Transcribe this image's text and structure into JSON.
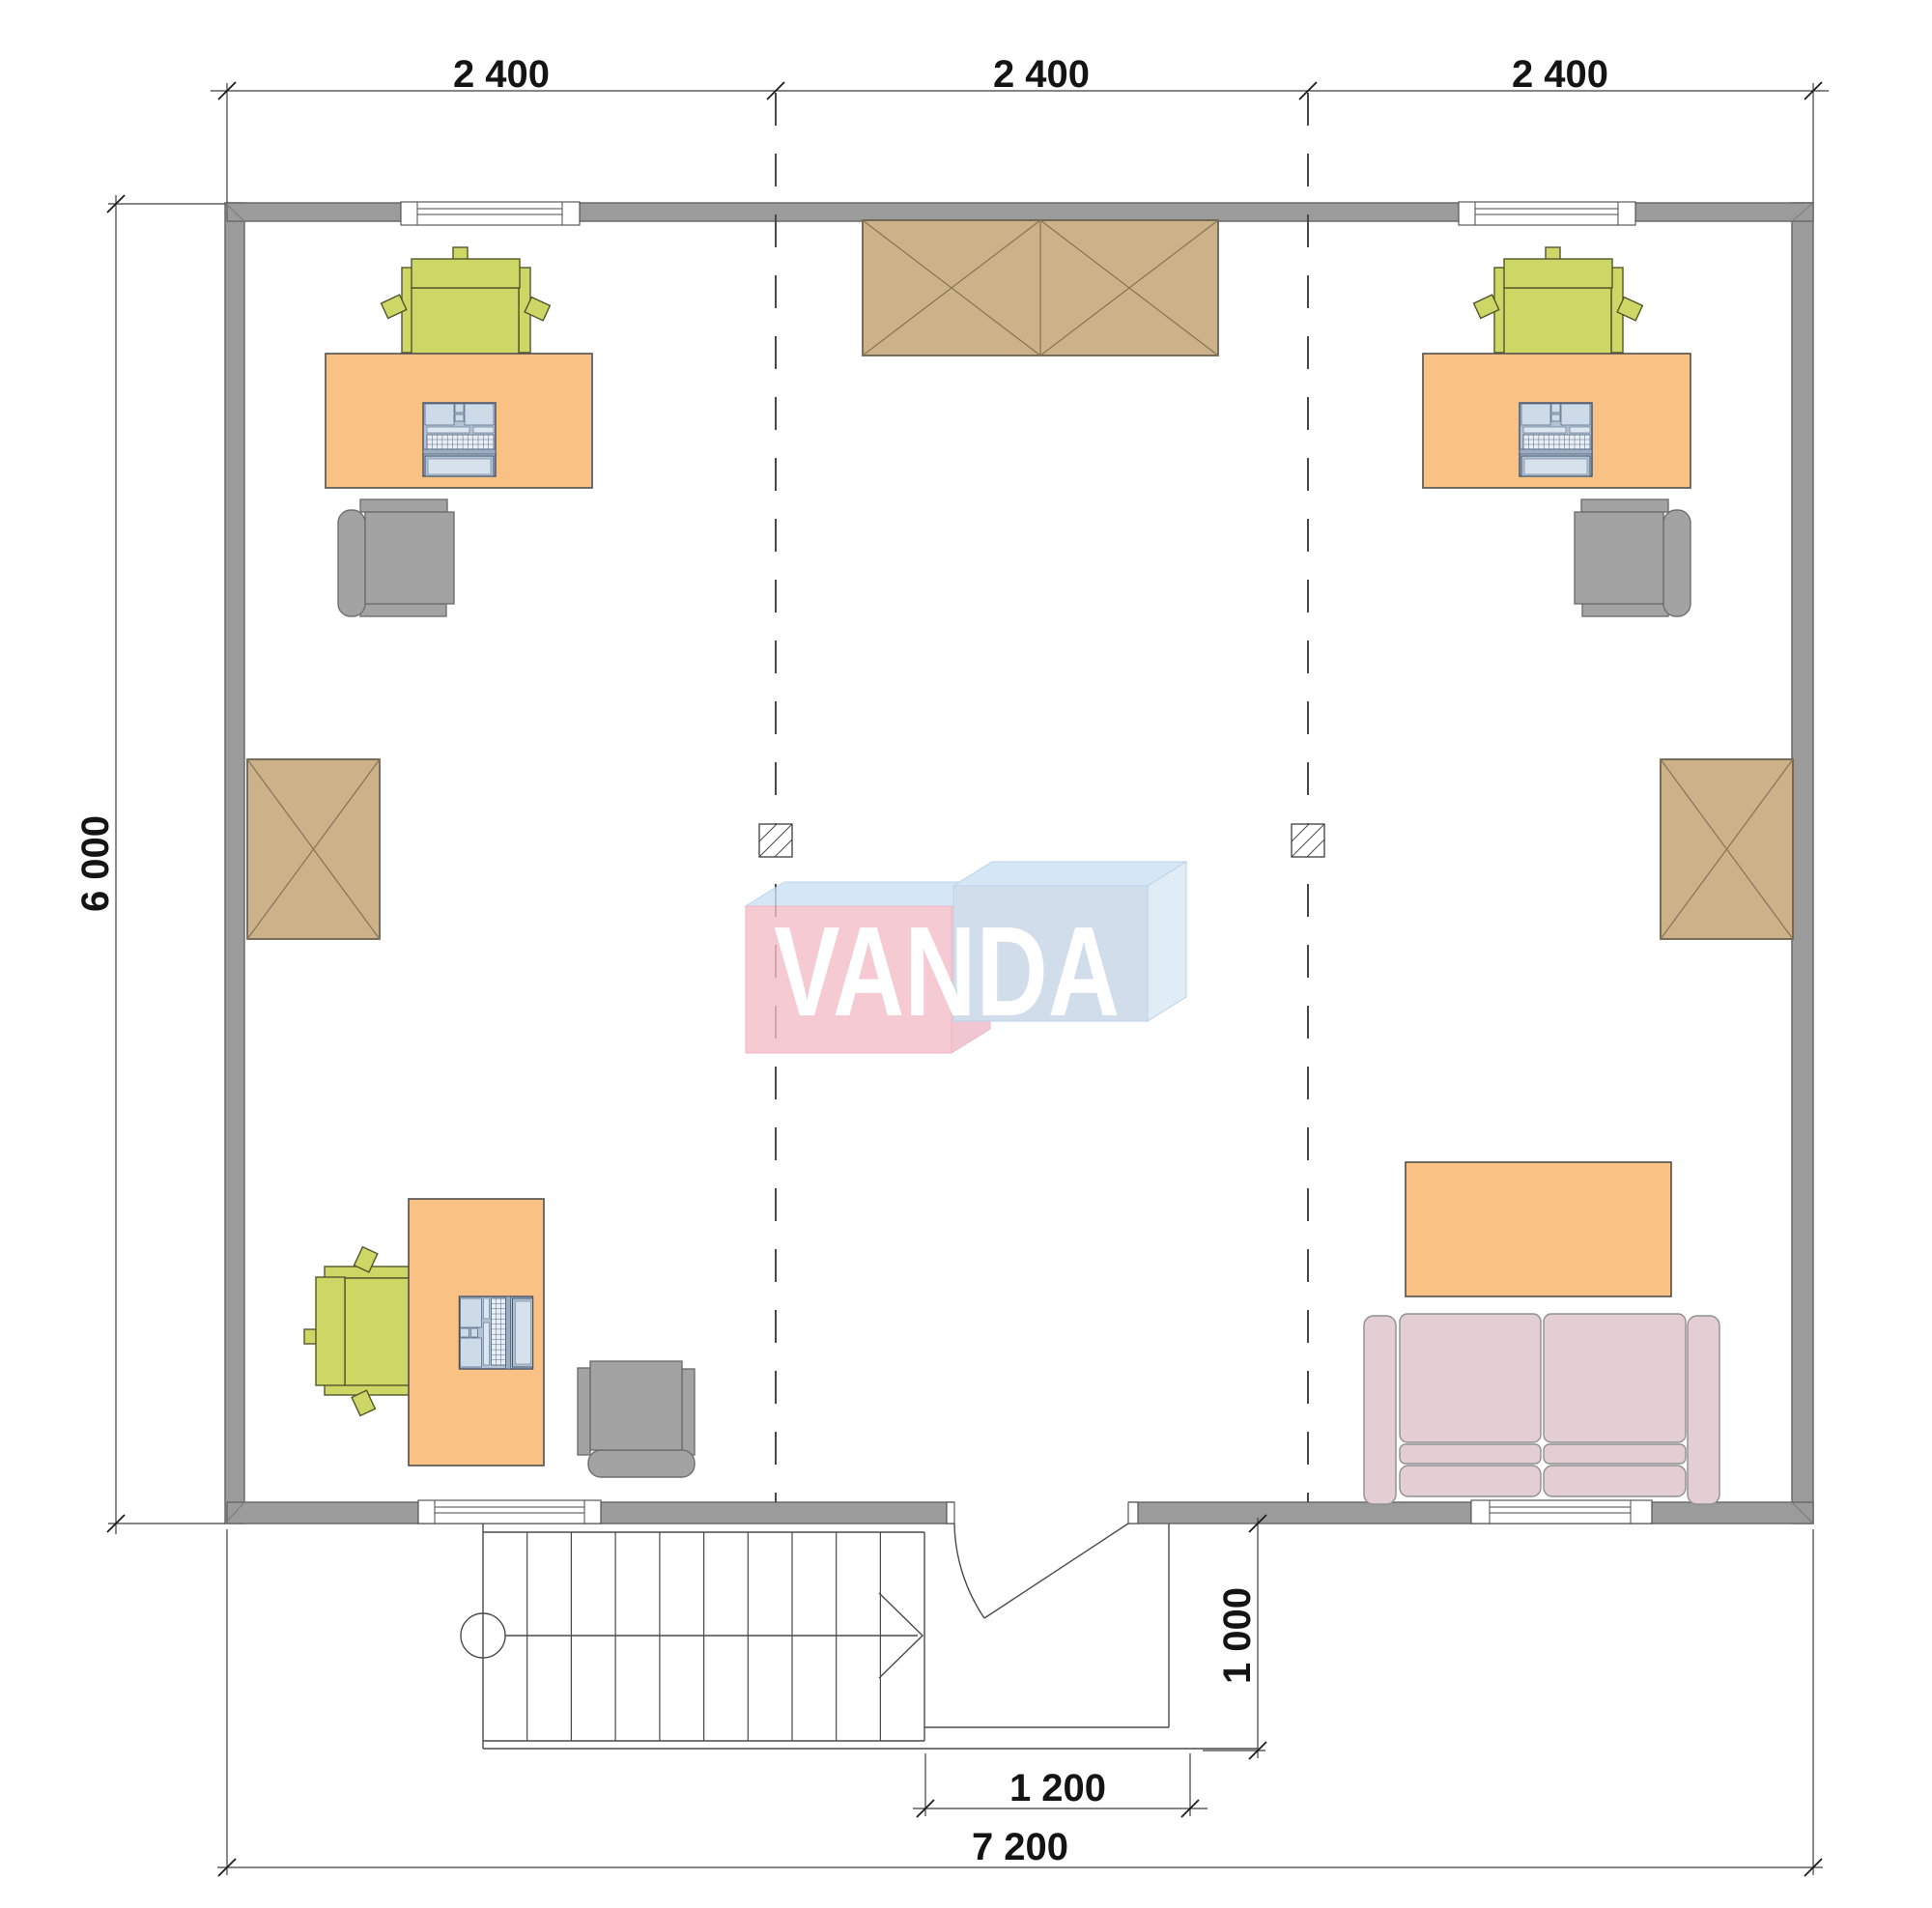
{
  "watermark": {
    "text": "VANDA"
  },
  "dimensions": {
    "top": [
      {
        "label": "2 400"
      },
      {
        "label": "2 400"
      },
      {
        "label": "2 400"
      }
    ],
    "left": {
      "label": "6 000"
    },
    "entry_depth": {
      "label": "1 000"
    },
    "entry_width": {
      "label": "1 200"
    },
    "total_width": {
      "label": "7 200"
    }
  },
  "colors": {
    "wall": "#9b9b9b",
    "wall_border": "#6b6b6b",
    "line": "#4a4a4a",
    "desk": "#f9c184",
    "wardrobe": "#ccb189",
    "chair_green": "#ccd765",
    "chair_gray": "#a3a3a3",
    "sofa": "#e3ced4",
    "logo_pink": "#f3bdc8",
    "logo_blue": "#c8d5e8",
    "logo_top": "#cbe2f2",
    "logo_side": "#d9e8f5",
    "laptop_body": "#b3c3d6",
    "laptop_screen": "#d6e1ec"
  }
}
